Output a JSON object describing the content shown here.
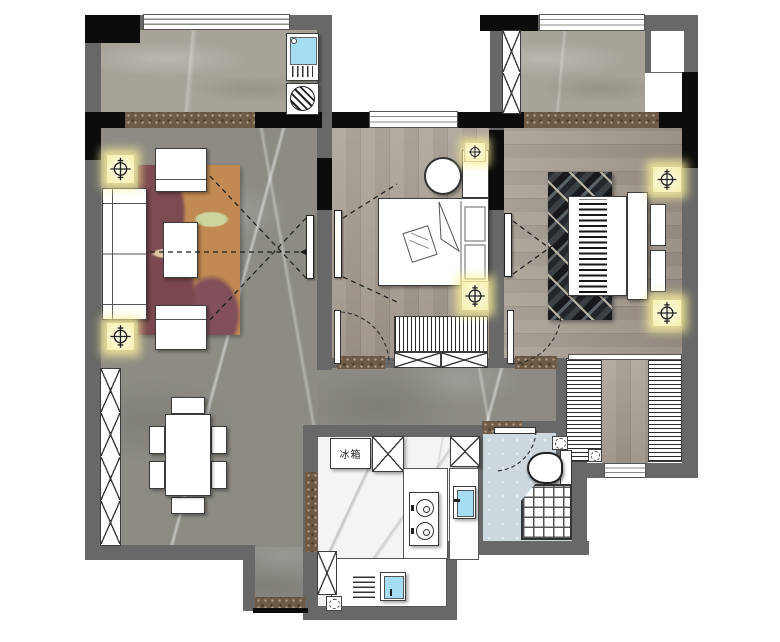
{
  "floorplan": {
    "type": "residential apartment floor plan, top-down render",
    "labels": {
      "fridge": "冰箱"
    },
    "colors": {
      "wall": "#686868",
      "wallDark": "#0c0c0c",
      "balconyFloor": "#a7a399",
      "livingFloor": "#8e8b85",
      "woodFloor": "#a69c92",
      "kitchenFloor": "#f5f4f2",
      "bathFloor": "#ccd8de",
      "threshold": "#6e5a45",
      "lightYellow": "#f5efa6",
      "sinkBlue": "#a5ddf2",
      "rugOrange": "#c18a52",
      "rugMaroon": "#7d4a52",
      "rugGreen": "#cbd69e",
      "furnitureLine": "#3c3c3c"
    },
    "rooms": [
      "balcony-top-left",
      "living-room",
      "dining-area",
      "second-bedroom",
      "master-bedroom",
      "balcony-top-right",
      "hallway",
      "kitchen",
      "bathroom",
      "walk-in-closet",
      "entry-vestibule"
    ],
    "fixtures": [
      "laundry-sink",
      "washing-machine",
      "sofa",
      "armchair",
      "coffee-table",
      "tv-panel",
      "area-rug",
      "dining-table",
      "dining-chair",
      "storage-cabinet",
      "round-side-table",
      "double-bed",
      "bedside-table",
      "ceiling-light",
      "wardrobe",
      "refrigerator",
      "gas-stove",
      "kitchen-sink",
      "dish-rack",
      "washbasin",
      "toilet",
      "corner-shower",
      "window",
      "door-swing"
    ]
  }
}
